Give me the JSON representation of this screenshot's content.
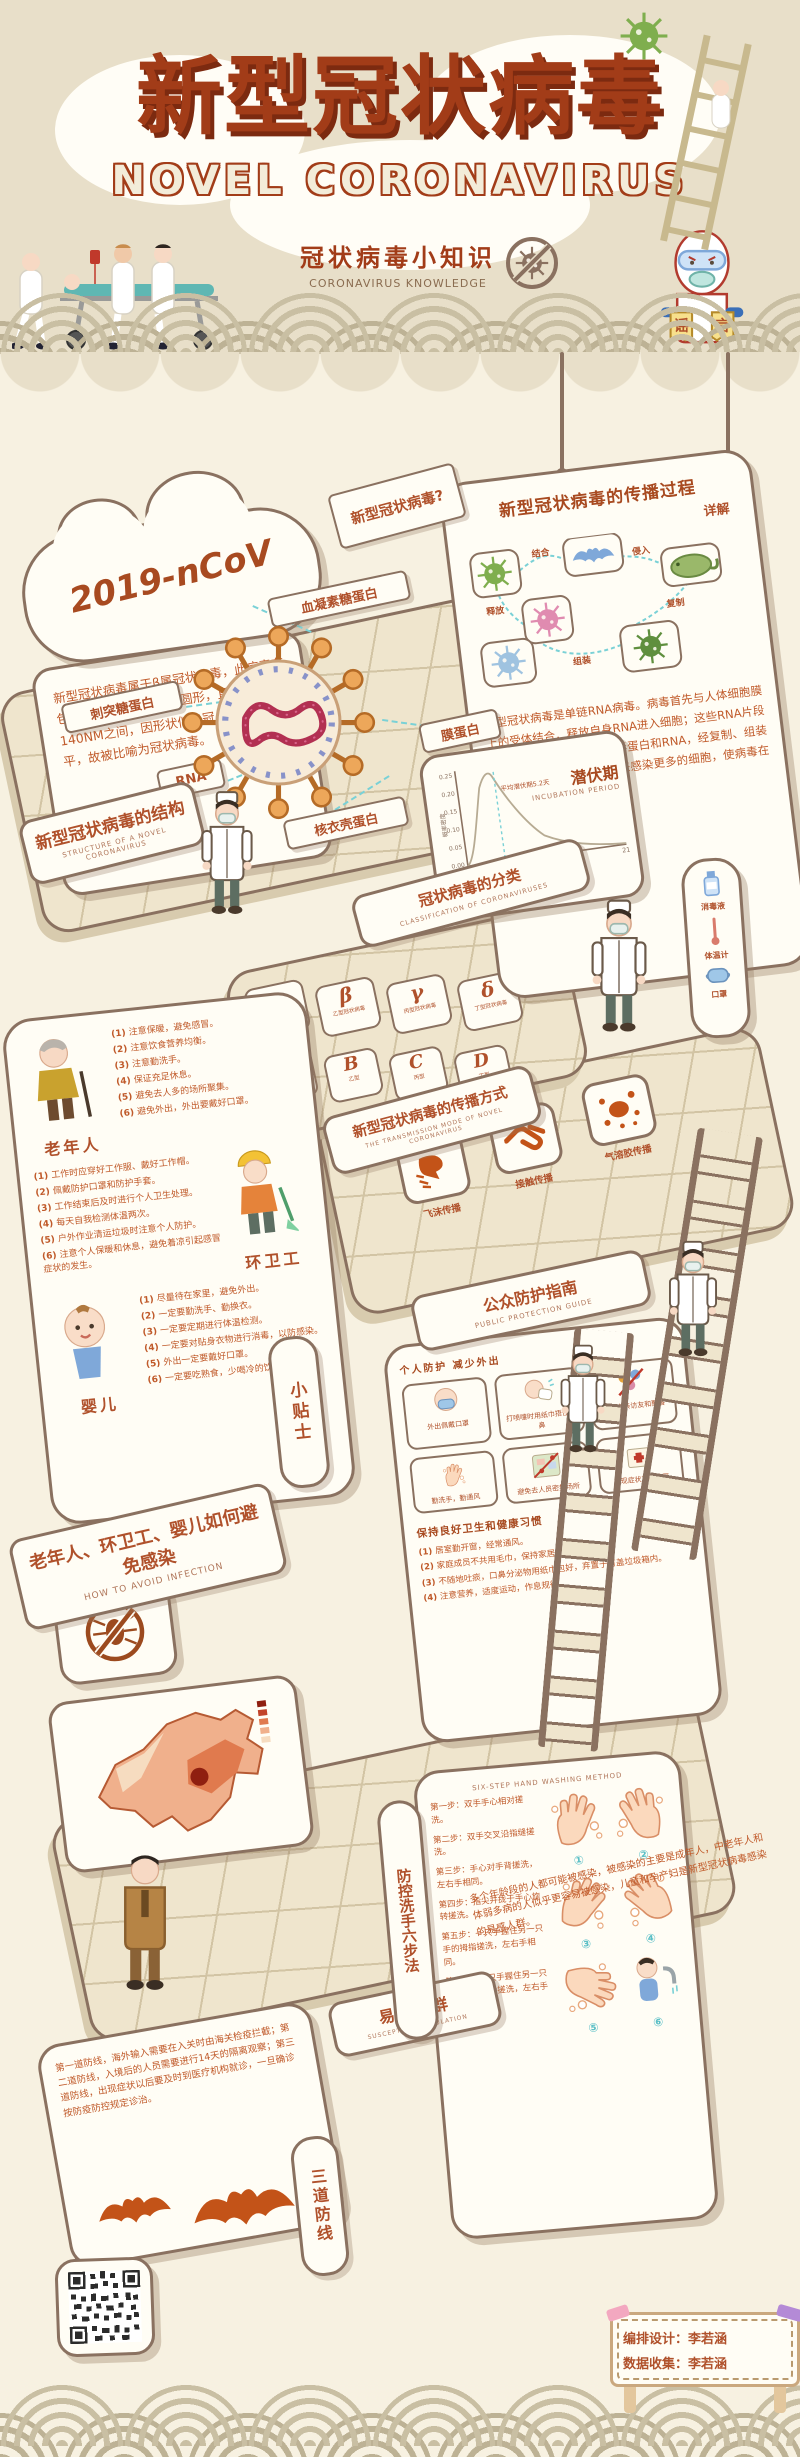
{
  "header": {
    "title_cn": "新型冠状病毒",
    "title_en": "NOVEL CORONAVIRUS",
    "subtitle_cn": "冠状病毒小知识",
    "subtitle_en": "CORONAVIRUS KNOWLEDGE",
    "rumor_char_left": "谣",
    "rumor_char_right": "言"
  },
  "colors": {
    "accent": "#b0512b",
    "panel_border": "#8a7160",
    "bg_top": "#e8dfc9",
    "bg_main": "#f7f1e1",
    "teal": "#7ad1d6",
    "orange": "#c35318"
  },
  "cloud": {
    "label": "2019-nCoV",
    "text": "新型冠状病毒属于β属冠状病毒，此病毒有包膜，颗粒呈圆形或椭圆形，直径在60-140NM之间，因形状似皇冠、表面凸凹不平，故被比喻为冠状病毒。"
  },
  "question_sign": "新型冠状病毒?",
  "spread_process": {
    "title": "新型冠状病毒的传播过程",
    "subtitle": "详解",
    "body": "新型冠状病毒是单链RNA病毒。病毒首先与人体细胞膜上的受体结合，释放自身RNA进入细胞；这些RNA片段会利用细胞合成更多的病毒蛋白和RNA，经复制、组装生成新的病毒，再释放出来感染更多的细胞，使病毒在体内不断传播增殖。",
    "step_labels": [
      "结合",
      "侵入",
      "复制",
      "组装",
      "释放"
    ]
  },
  "structure": {
    "sign_cn": "新型冠状病毒的结构",
    "sign_en": "STRUCTURE OF A NOVEL CORONAVIRUS",
    "labels": [
      "血凝素糖蛋白",
      "刺突糖蛋白",
      "RNA",
      "核衣壳蛋白",
      "膜蛋白"
    ]
  },
  "incubation": {
    "title_cn": "潜伏期",
    "title_en": "INCUBATION PERIOD",
    "annotation": "平均潜伏期5.2天",
    "xlabel": "从感染到发病的时间（天）",
    "ylabel": "概率密度",
    "yticks": [
      "0.25",
      "0.20",
      "0.15",
      "0.10",
      "0.05",
      "0.00"
    ],
    "xticks": [
      "7",
      "14",
      "21"
    ]
  },
  "chart_data": {
    "type": "area",
    "title": "潜伏期 INCUBATION PERIOD",
    "xlabel": "从感染到发病的时间（天）",
    "ylabel": "概率密度",
    "x": [
      0,
      1,
      2,
      3,
      4,
      5,
      6,
      7,
      8,
      10,
      12,
      14,
      17,
      21
    ],
    "values": [
      0,
      0.02,
      0.08,
      0.17,
      0.23,
      0.25,
      0.22,
      0.18,
      0.14,
      0.09,
      0.05,
      0.03,
      0.015,
      0.005
    ],
    "annotation": "平均潜伏期5.2天",
    "xlim": [
      0,
      21
    ],
    "ylim": [
      0,
      0.25
    ],
    "xticks": [
      7,
      14,
      21
    ],
    "yticks": [
      0.0,
      0.05,
      0.1,
      0.15,
      0.2,
      0.25
    ],
    "legend": "off",
    "grid": "off"
  },
  "classification": {
    "sign_cn": "冠状病毒的分类",
    "sign_en": "CLASSIFICATION OF CORONAVIRUSES",
    "tiles": [
      {
        "letter": "α",
        "label": "甲型冠状病毒"
      },
      {
        "letter": "β",
        "label": "乙型冠状病毒"
      },
      {
        "letter": "γ",
        "label": "丙型冠状病毒"
      },
      {
        "letter": "δ",
        "label": "丁型冠状病毒"
      },
      {
        "letter": "A",
        "label": "甲型"
      },
      {
        "letter": "B",
        "label": "乙型"
      },
      {
        "letter": "C",
        "label": "丙型"
      },
      {
        "letter": "D",
        "label": "丁型"
      }
    ]
  },
  "transmission_mode": {
    "sign_cn": "新型冠状病毒的传播方式",
    "sign_en": "THE TRANSMISSION MODE OF NOVEL CORONAVIRUS",
    "modes": [
      "飞沫传播",
      "接触传播",
      "气溶胶传播"
    ]
  },
  "avoid_infection": {
    "sign_cn": "老年人、环卫工、婴儿如何避免感染",
    "sign_en": "HOW TO AVOID INFECTION",
    "tip_sign": "小贴士",
    "groups": [
      {
        "name": "老年人",
        "tips": [
          "注意保暖，避免感冒。",
          "注意饮食营养均衡。",
          "注意勤洗手。",
          "保证充足休息。",
          "避免去人多的场所聚集。",
          "避免外出，外出要戴好口罩。"
        ]
      },
      {
        "name": "环卫工",
        "tips": [
          "工作时应穿好工作服、戴好工作帽。",
          "佩戴防护口罩和防护手套。",
          "工作结束后及时进行个人卫生处理。",
          "每天自我检测体温两次。",
          "户外作业清运垃圾时注意个人防护。",
          "注意个人保暖和休息，避免着凉引起感冒症状的发生。"
        ]
      },
      {
        "name": "婴儿",
        "tips": [
          "尽量待在家里，避免外出。",
          "一定要勤洗手、勤换衣。",
          "一定要定期进行体温检测。",
          "一定要对贴身衣物进行消毒，以防感染。",
          "外出一定要戴好口罩。",
          "一定要吃熟食，少喝冷的饮料。"
        ]
      }
    ]
  },
  "protection_guide": {
    "sign_cn": "公众防护指南",
    "sign_en": "PUBLIC PROTECTION GUIDE",
    "section1": "个人防护 减少外出",
    "tiles": [
      "外出佩戴口罩",
      "打喷嚏时用纸巾捂住口鼻",
      "减少走亲访友和聚餐",
      "勤洗手，勤通风",
      "避免去人员密集场所",
      "出现症状及时就医"
    ],
    "section2": "保持良好卫生和健康习惯",
    "habits": [
      "居室勤开窗，经常通风。",
      "家庭成员不共用毛巾，保持家居、餐具清洁。",
      "不随地吐痰，口鼻分泌物用纸巾包好，弃置于有盖垃圾箱内。",
      "注意营养，适度运动，作息规律。"
    ]
  },
  "supplies": [
    "消毒液",
    "体温计",
    "口罩"
  ],
  "susceptible": {
    "sign_cn": "易感人群",
    "sign_en": "SUSCEPTIBLE POPULATION",
    "text": "多个年龄段的人都可能被感染，被感染的主要是成年人，中老年人和体弱多病的人似乎更容易被感染，儿童和孕产妇是新型冠状病毒感染的易感人群。"
  },
  "defense": {
    "sign": "三道防线",
    "text": "第一道防线，海外输入需要在入关时由海关检疫拦截；第二道防线，入境后的人员需要进行14天的隔离观察；第三道防线，出现症状以后要及时到医疗机构就诊，一旦确诊按防疫防控规定诊治。"
  },
  "handwash": {
    "sign_cn": "防控洗手六步法",
    "sign_en": "SIX-STEP HAND WASHING METHOD",
    "steps": [
      {
        "no": "①",
        "text": "第一步：双手手心相对搓洗。"
      },
      {
        "no": "②",
        "text": "第二步：双手交叉沿指缝搓洗。"
      },
      {
        "no": "③",
        "text": "第三步：手心对手背搓洗，左右手相同。"
      },
      {
        "no": "④",
        "text": "第四步：指尖并拢于手心旋转搓洗。"
      },
      {
        "no": "⑤",
        "text": "第五步：一只手握住另一只手的拇指搓洗，左右手相同。"
      },
      {
        "no": "⑥",
        "text": "第六步：一只手握住另一只手的手腕转动搓洗，左右手相同。"
      }
    ]
  },
  "credits": {
    "line1": "编排设计：李若涵",
    "line2": "数据收集：李若涵"
  }
}
